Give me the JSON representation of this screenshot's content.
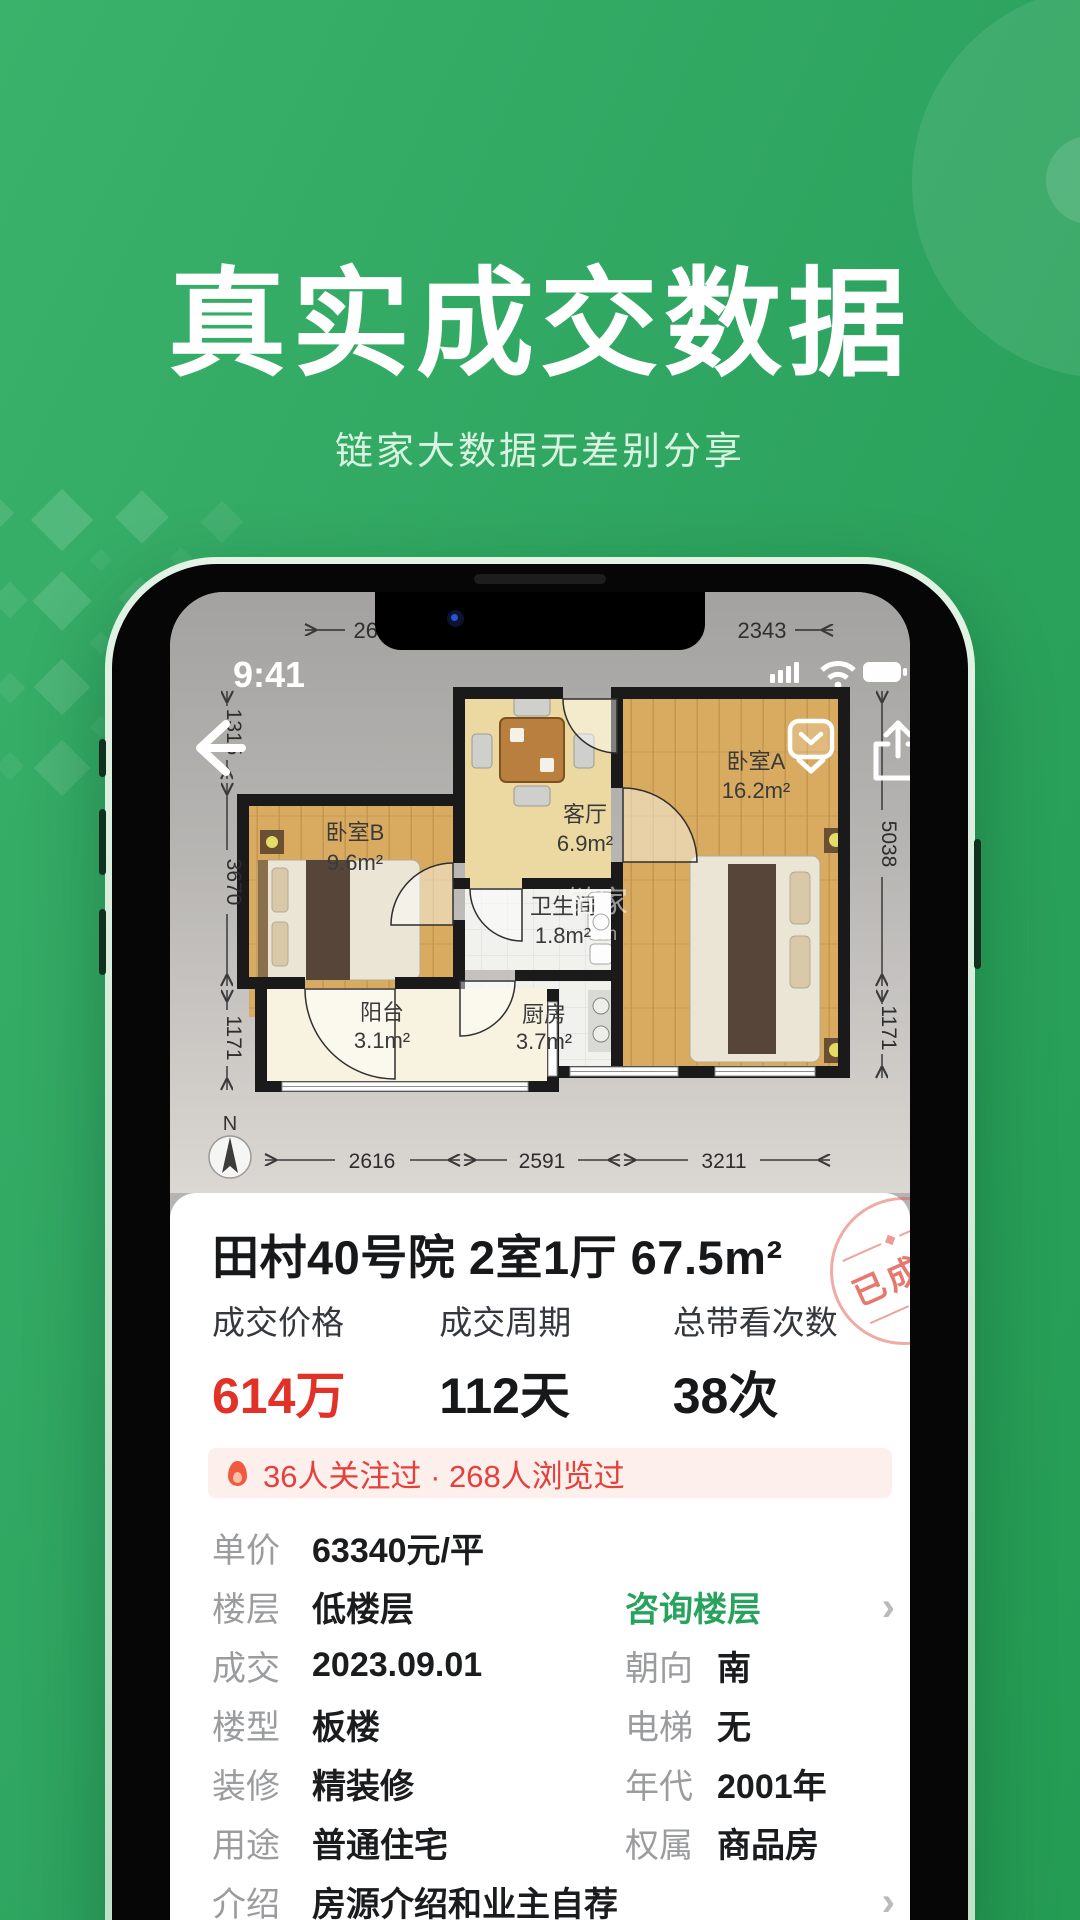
{
  "hero": {
    "title": "真实成交数据",
    "subtitle": "链家大数据无差别分享"
  },
  "status_bar": {
    "time": "9:41"
  },
  "floorplan": {
    "dims_top": [
      "2616",
      "2343"
    ],
    "dims_left": [
      "1315",
      "3670",
      "1171"
    ],
    "dims_right": [
      "5038",
      "1171"
    ],
    "dims_bottom": [
      "2616",
      "2591",
      "3211"
    ],
    "compass": "N",
    "watermark_cn": "链家",
    "watermark_com": ".com",
    "rooms": [
      {
        "name": "卧室B",
        "area": "9.6m²"
      },
      {
        "name": "客厅",
        "area": "6.9m²"
      },
      {
        "name": "卫生间",
        "area": "1.8m²"
      },
      {
        "name": "厨房",
        "area": "3.7m²"
      },
      {
        "name": "卧室A",
        "area": "16.2m²"
      },
      {
        "name": "阳台",
        "area": "3.1m²"
      }
    ]
  },
  "card": {
    "title": "田村40号院 2室1厅 67.5m²",
    "stamp": "已成交",
    "stats": [
      {
        "label": "成交价格",
        "value": "614万",
        "sub_prefix": "比挂牌价",
        "sub_accent": "少11万"
      },
      {
        "label": "成交周期",
        "value": "112天",
        "sub_prefix": "比平均",
        "sub_accent": "少8天"
      },
      {
        "label": "总带看次数",
        "value": "38次",
        "sub_prefix": "比平均",
        "sub_accent": "少8次"
      }
    ],
    "notice": "36人关注过 · 268人浏览过",
    "rows": [
      {
        "label": "单价",
        "value": "63340元/平"
      },
      {
        "label": "楼层",
        "value": "低楼层",
        "right_link": "咨询楼层"
      },
      {
        "label": "成交",
        "value": "2023.09.01",
        "right_label": "朝向",
        "right_value": "南"
      },
      {
        "label": "楼型",
        "value": "板楼",
        "right_label": "电梯",
        "right_value": "无"
      },
      {
        "label": "装修",
        "value": "精装修",
        "right_label": "年代",
        "right_value": "2001年"
      },
      {
        "label": "用途",
        "value": "普通住宅",
        "right_label": "权属",
        "right_value": "商品房"
      },
      {
        "label": "介绍",
        "value": "房源介绍和业主自荐"
      }
    ]
  },
  "icons": {
    "chevron": "›"
  },
  "colors": {
    "accent_green": "#27a35d",
    "price_red": "#e23227",
    "notice_red": "#e5403b",
    "notice_bg": "#fcefec",
    "hero_green": "#2ea560"
  }
}
